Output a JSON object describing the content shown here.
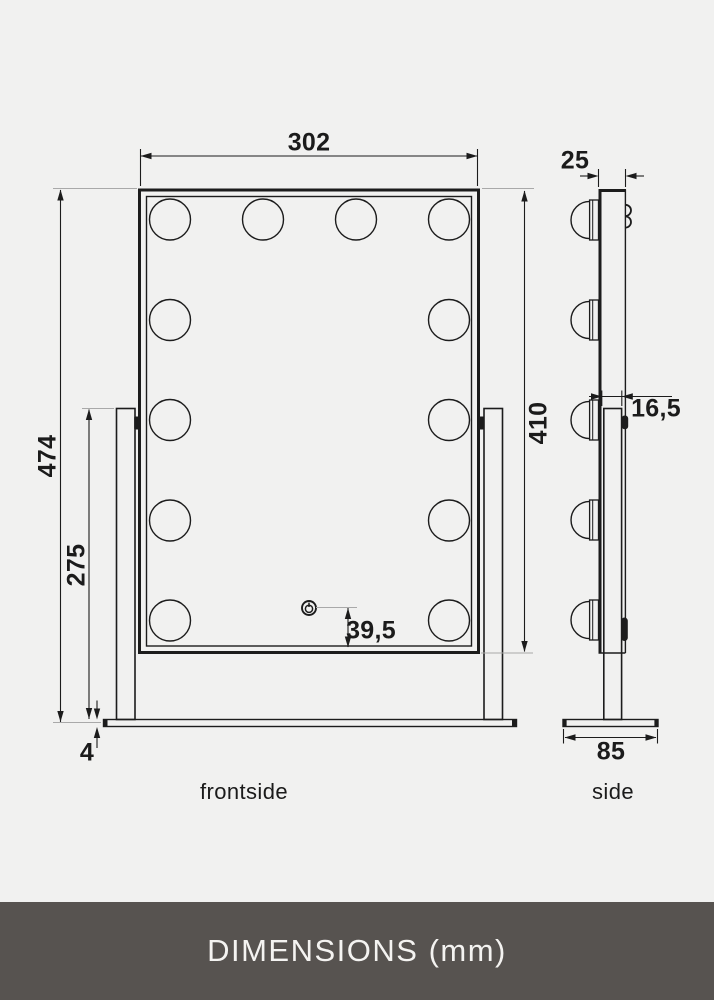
{
  "colors": {
    "background": "#f1f1f0",
    "line": "#1c1c1c",
    "extension_line": "#a9a9a9",
    "footer_background": "#575350",
    "footer_text": "#f4f3f1"
  },
  "front_view": {
    "label": "frontside",
    "bulb_count": 12,
    "dimensions": {
      "width": "302",
      "total_height": "474",
      "stand_height": "275",
      "base_thickness": "4",
      "mirror_height": "410",
      "power_button_offset": "39,5"
    }
  },
  "side_view": {
    "label": "side",
    "bulb_count": 5,
    "dimensions": {
      "mirror_depth": "25",
      "stand_depth": "16,5",
      "base_depth": "85"
    }
  },
  "footer": {
    "title": "DIMENSIONS (mm)"
  }
}
